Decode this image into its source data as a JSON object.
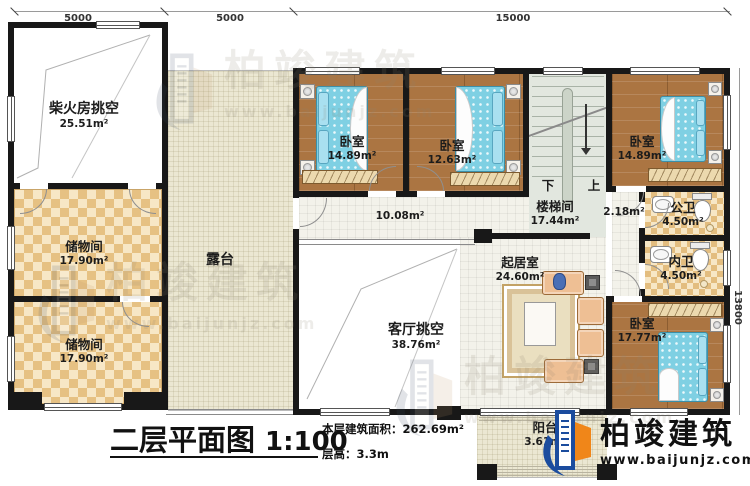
{
  "dimensions": {
    "top_left": "5000",
    "top_mid": "5000",
    "top_right": "15000",
    "right_side": "13800"
  },
  "rooms": {
    "firewood_void": {
      "name": "柴火房挑空",
      "area": "25.51m²"
    },
    "storage_1": {
      "name": "储物间",
      "area": "17.90m²"
    },
    "storage_2": {
      "name": "储物间",
      "area": "17.90m²"
    },
    "terrace": {
      "name": "露台"
    },
    "hallway": {
      "area": "10.08m²"
    },
    "bedroom_1": {
      "name": "卧室",
      "area": "14.89m²"
    },
    "bedroom_2": {
      "name": "卧室",
      "area": "12.63m²"
    },
    "stairwell": {
      "name": "楼梯间",
      "area": "17.44m²",
      "down_label": "下",
      "up_label": "上"
    },
    "corridor": {
      "area": "2.18m²"
    },
    "bedroom_3": {
      "name": "卧室",
      "area": "14.89m²"
    },
    "public_bath": {
      "name": "公卫",
      "area": "4.50m²"
    },
    "ensuite_bath": {
      "name": "内卫",
      "area": "4.50m²"
    },
    "bedroom_4": {
      "name": "卧室",
      "area": "17.77m²"
    },
    "family_room": {
      "name": "起居室",
      "area": "24.60m²"
    },
    "living_void": {
      "name": "客厅挑空",
      "area": "38.76m²"
    },
    "balcony": {
      "name": "阳台",
      "area": "3.61m²"
    }
  },
  "title": {
    "text": "二层平面图",
    "scale": "1:100",
    "area_note": "本层建筑面积：262.69m²",
    "height_note": "层高：3.3m"
  },
  "brand": {
    "name": "柏竣建筑",
    "url": "www.baijunjz.com"
  },
  "watermark": {
    "name": "柏竣建筑",
    "url": "www.baijunjz.com"
  },
  "colors": {
    "wall": "#181818",
    "wood_floor": "#ab7542",
    "bed_blue": "#7fd0e3",
    "checker": "#e6c183",
    "terrace": "#ebe7d2",
    "stair": "#e2e7df",
    "sofa": "#eebf94",
    "logo_blue": "#1b4c9e",
    "logo_orange": "#f08619"
  }
}
